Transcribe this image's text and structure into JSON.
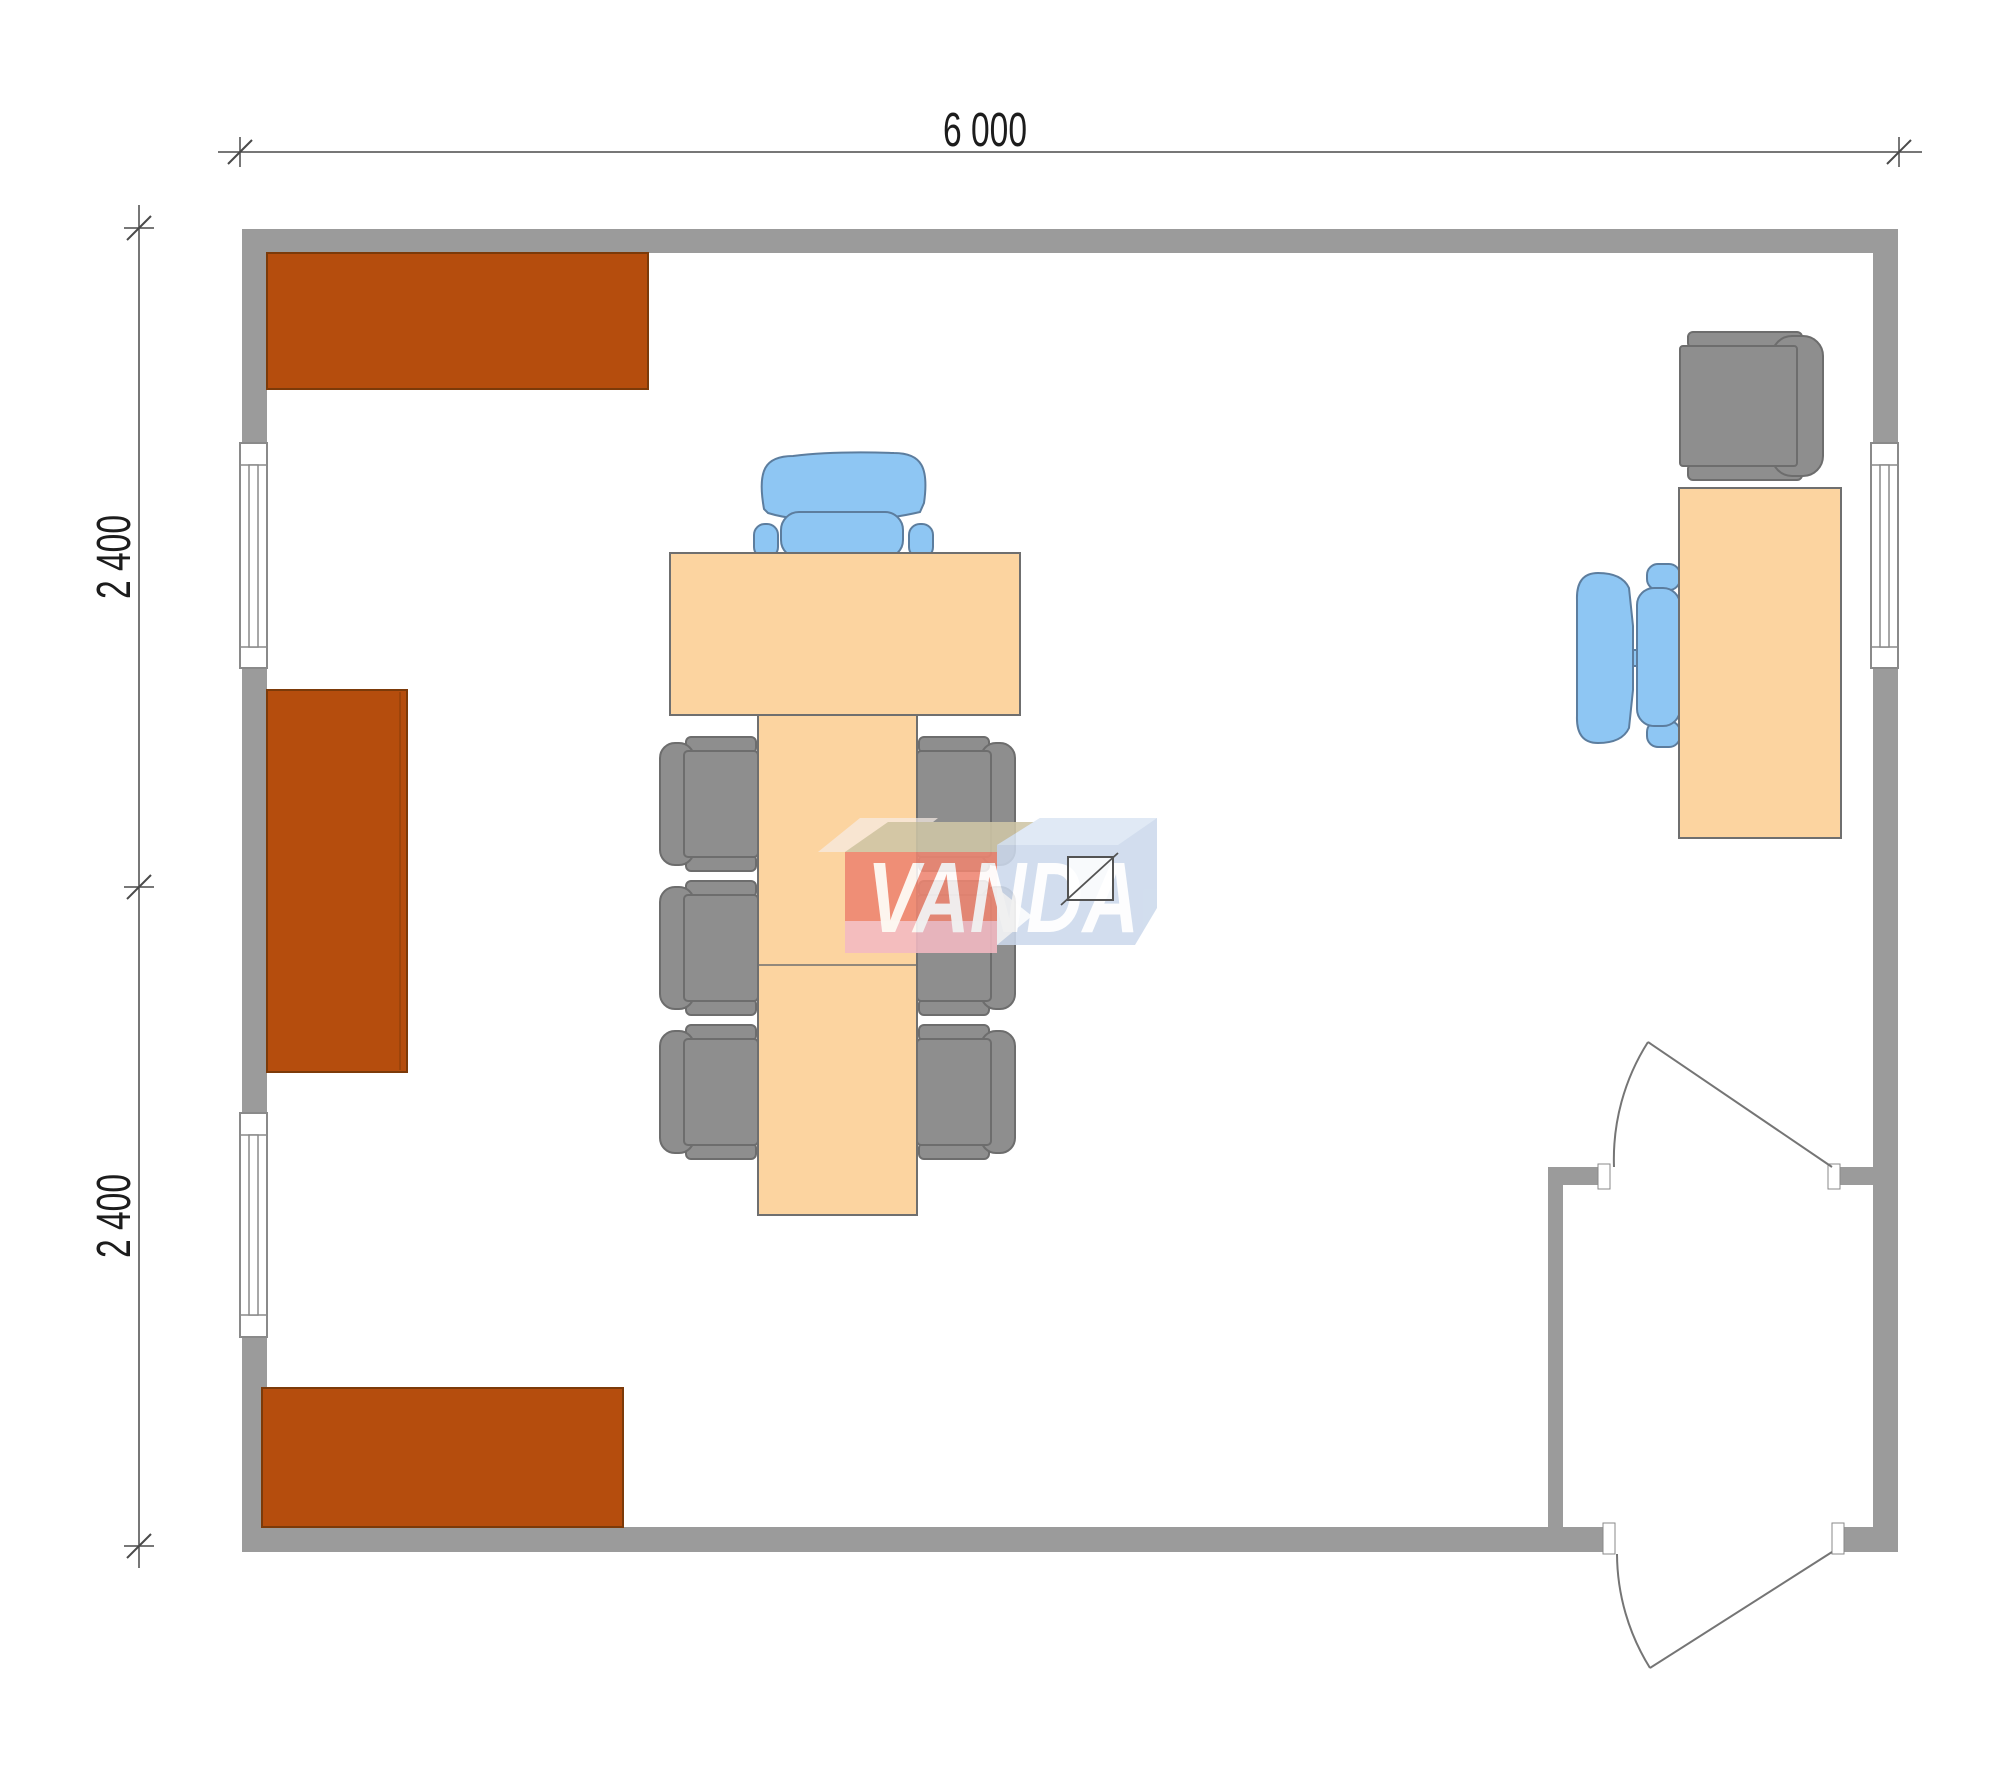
{
  "plan": {
    "type": "floor-plan",
    "room_width_label": "6 000",
    "room_depth_upper_label": "2 400",
    "room_depth_lower_label": "2 400"
  },
  "dimensions": {
    "width_label": "6 000",
    "height_upper_label": "2 400",
    "height_lower_label": "2 400"
  },
  "watermark": {
    "text": "VANDA"
  },
  "colors": {
    "wall": "#9b9b9b",
    "window_line": "#8a8a8a",
    "door_line": "#757575",
    "cabinet": "#b54d0d",
    "cabinet_border": "#7c3a09",
    "table": "#fcd4a0",
    "table_border": "#6f6f6f",
    "chair_gray": "#8e8e8e",
    "chair_gray_border": "#6d6d6d",
    "chair_blue": "#8ec6f3",
    "chair_blue_border": "#5c7d9e",
    "dim_line": "#4a4a4a",
    "dim_text": "#1c1c1c",
    "wm_red": "#ee8571",
    "wm_red_top": "#cfc6a6",
    "wm_pink": "#f4bac3",
    "wm_blue": "#ccd9ec",
    "wm_blue_top": "#dce7f4"
  }
}
